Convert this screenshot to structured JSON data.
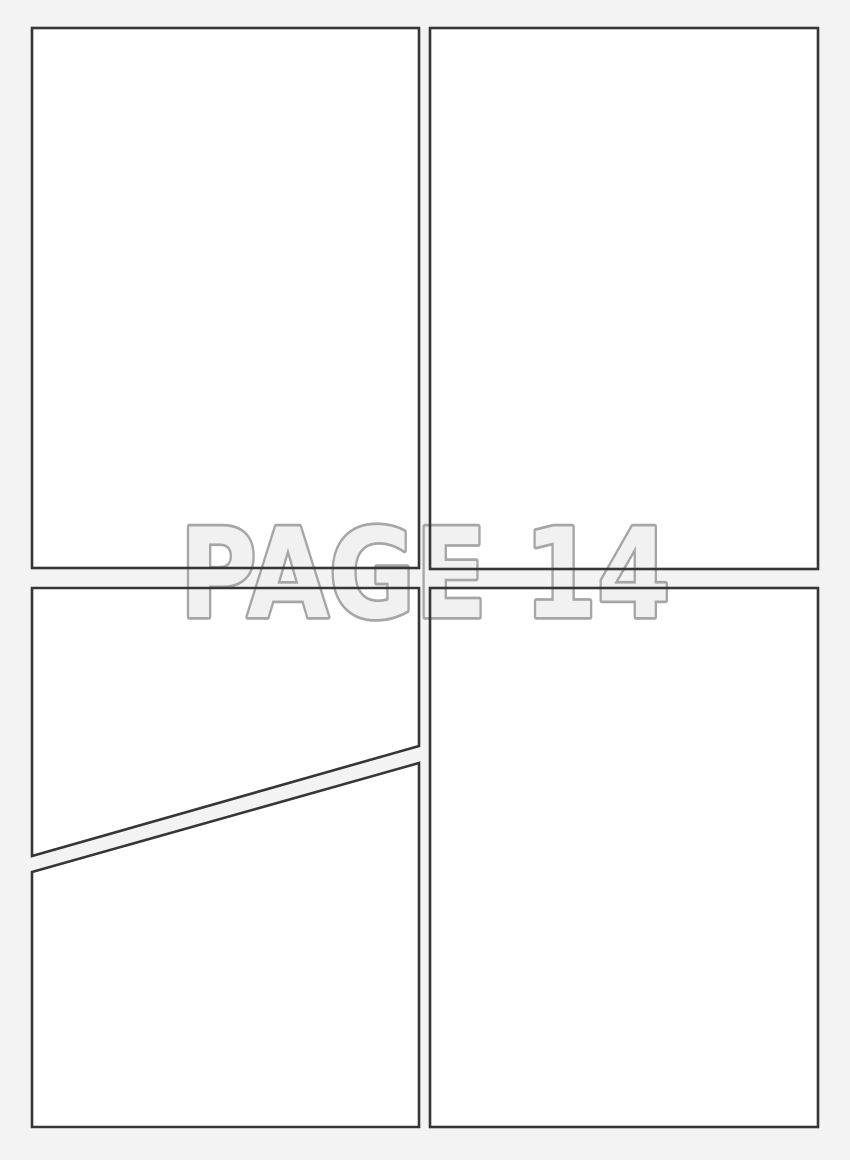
{
  "page": {
    "watermark_text": "PAGE 14",
    "colors": {
      "background": "#f3f3f4",
      "panel_fill": "#ffffff",
      "panel_border": "#363636",
      "watermark_fill": "#f1f1f1",
      "watermark_stroke": "#a6a6a6"
    },
    "panels": [
      {
        "id": "panel-top-left",
        "shape": "rectangle"
      },
      {
        "id": "panel-top-right",
        "shape": "rectangle"
      },
      {
        "id": "panel-bottom-left-upper",
        "shape": "diagonal-trapezoid"
      },
      {
        "id": "panel-bottom-left-lower",
        "shape": "diagonal-trapezoid"
      },
      {
        "id": "panel-bottom-right",
        "shape": "rectangle"
      }
    ]
  }
}
